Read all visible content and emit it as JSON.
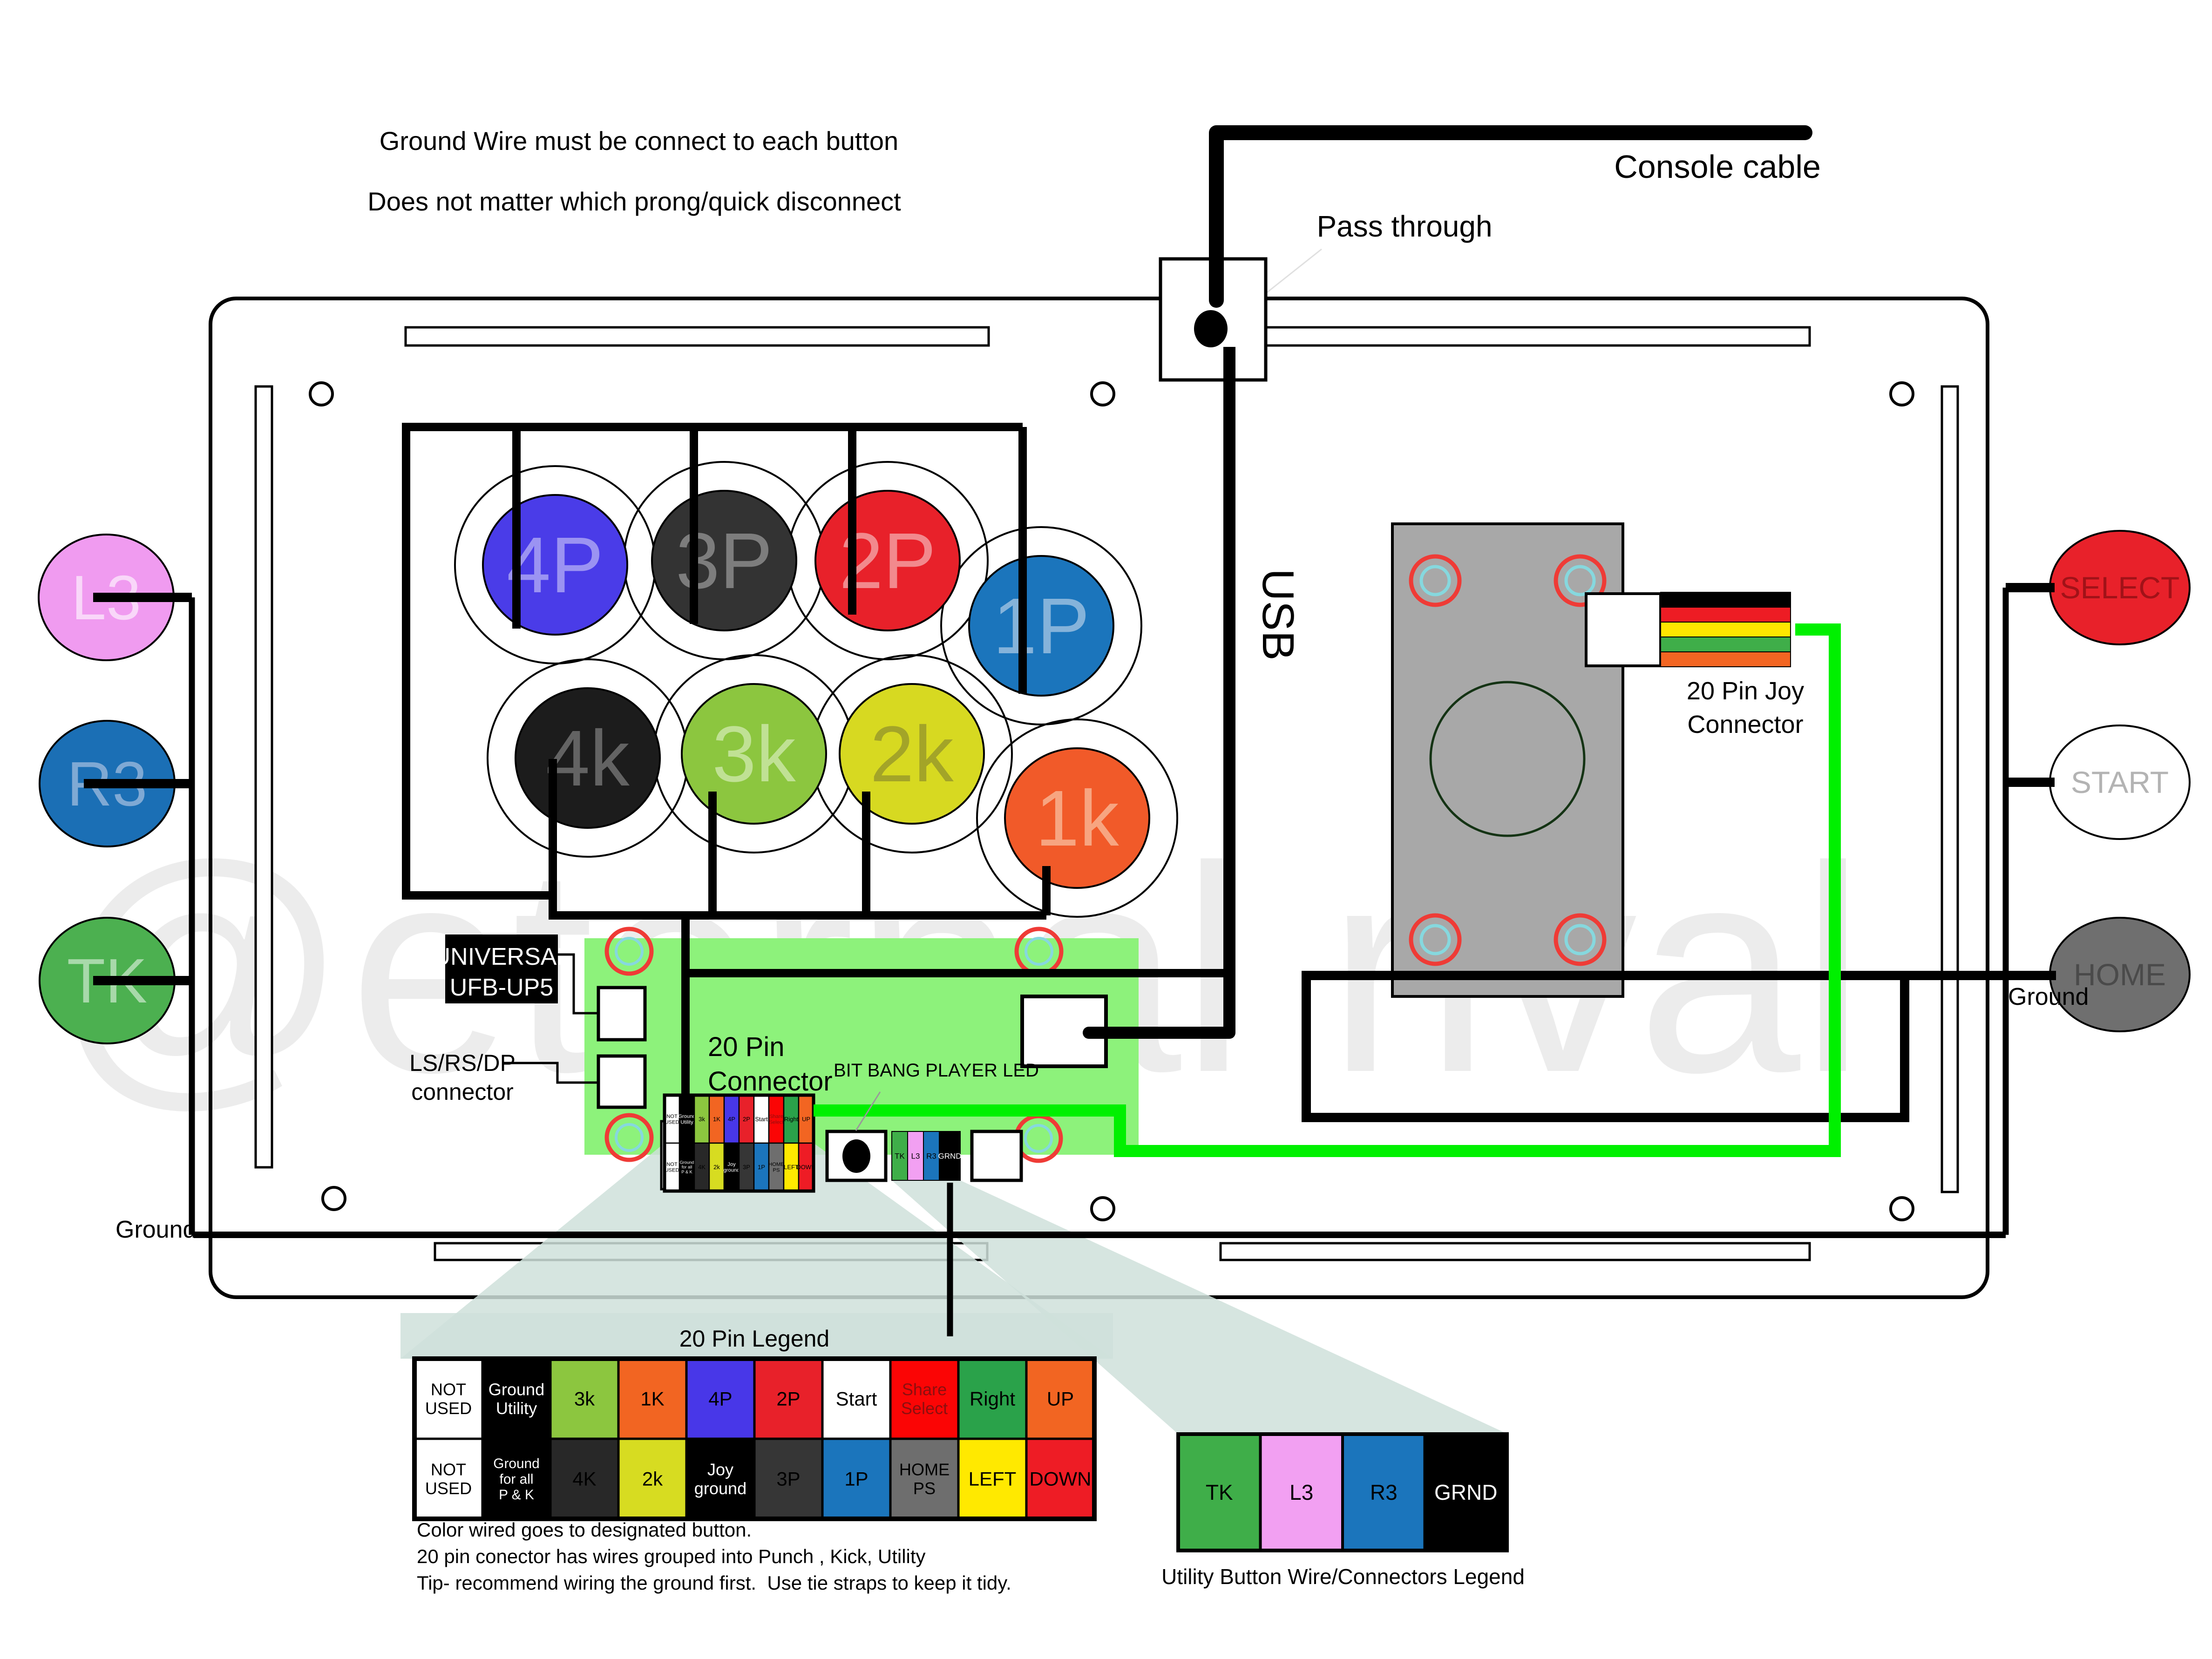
{
  "top_note": {
    "line1": "Ground Wire must be connect to each button",
    "line2": "Does not matter which prong/quick disconnect"
  },
  "labels": {
    "console_cable": "Console cable",
    "pass_through": "Pass through",
    "usb": "USB",
    "universal_line1": "UNIVERSAL",
    "universal_line2": "UFB-UP5",
    "lsrsdp_line1": "LS/RS/DP",
    "lsrsdp_line2": "connector",
    "pin20_line1": "20 Pin",
    "pin20_line2": "Connector",
    "bitbang": "BIT BANG PLAYER LED",
    "joy_line1": "20 Pin Joy",
    "joy_line2": "Connector",
    "ground_left": "Ground",
    "ground_right": "Ground",
    "legend20_title": "20 Pin Legend",
    "utility_title": "Utility Button Wire/Connectors Legend"
  },
  "notes": [
    "Color wired goes to designated button.",
    "20 pin conector has wires grouped into Punch , Kick, Utility",
    "Tip- recommend wiring the ground first.  Use tie straps to keep it tidy."
  ],
  "watermark": "@eternal rival",
  "buttons": {
    "main": [
      {
        "label": "4P",
        "color": "#4a3ce8",
        "text_color": "#9b93f2"
      },
      {
        "label": "3P",
        "color": "#333333",
        "text_color": "#7d7d7d"
      },
      {
        "label": "2P",
        "color": "#e8212a",
        "text_color": "#f2898d"
      },
      {
        "label": "1P",
        "color": "#1b75bc",
        "text_color": "#85b3da"
      },
      {
        "label": "4k",
        "color": "#1c1c1c",
        "text_color": "#636363"
      },
      {
        "label": "3k",
        "color": "#8cc63f",
        "text_color": "#c0e194"
      },
      {
        "label": "2k",
        "color": "#d7d921",
        "text_color": "#a3a428"
      },
      {
        "label": "1k",
        "color": "#f15a29",
        "text_color": "#f7a581"
      }
    ],
    "left": [
      {
        "label": "L3",
        "color": "#f09bf0",
        "text_color": "#f9d7f9"
      },
      {
        "label": "R3",
        "color": "#1b6fb5",
        "text_color": "#7fa9d4"
      },
      {
        "label": "TK",
        "color": "#4cb050",
        "text_color": "#a8d9aa"
      }
    ],
    "right": [
      {
        "label": "SELECT",
        "color": "#e8212a",
        "text_color": "#a11218"
      },
      {
        "label": "START",
        "color": "#ffffff",
        "text_color": "#b3b3b3"
      },
      {
        "label": "HOME",
        "color": "#6f6f6f",
        "text_color": "#4a4a4a"
      }
    ]
  },
  "pins": {
    "row1": [
      {
        "label": "NOT USED",
        "lines": [
          "NOT",
          "USED"
        ],
        "bg": "#ffffff",
        "fg": "#000000"
      },
      {
        "label": "Ground Utility",
        "lines": [
          "Ground",
          "Utility"
        ],
        "bg": "#000000",
        "fg": "#ffffff"
      },
      {
        "label": "3k",
        "bg": "#8cc63f",
        "fg": "#000000"
      },
      {
        "label": "1K",
        "bg": "#f26522",
        "fg": "#000000"
      },
      {
        "label": "4P",
        "bg": "#4837e8",
        "fg": "#000000"
      },
      {
        "label": "2P",
        "bg": "#e8212a",
        "fg": "#000000"
      },
      {
        "label": "Start",
        "bg": "#ffffff",
        "fg": "#000000"
      },
      {
        "label": "Share Select",
        "lines": [
          "Share",
          "Select"
        ],
        "bg": "#fb0505",
        "fg": "#8b0f0f"
      },
      {
        "label": "Right",
        "bg": "#2aa24a",
        "fg": "#000000"
      },
      {
        "label": "UP",
        "bg": "#f26522",
        "fg": "#000000"
      }
    ],
    "row2": [
      {
        "label": "NOT USED",
        "lines": [
          "NOT",
          "USED"
        ],
        "bg": "#ffffff",
        "fg": "#000000"
      },
      {
        "label": "Ground for all P & K",
        "lines": [
          "Ground",
          "for all",
          "P & K"
        ],
        "small": true,
        "bg": "#000000",
        "fg": "#ffffff"
      },
      {
        "label": "4K",
        "bg": "#282828",
        "fg": "#000000"
      },
      {
        "label": "2k",
        "bg": "#d7dc21",
        "fg": "#000000"
      },
      {
        "label": "Joy ground",
        "lines": [
          "Joy",
          "ground"
        ],
        "bg": "#000000",
        "fg": "#ffffff"
      },
      {
        "label": "3P",
        "bg": "#363636",
        "fg": "#000000"
      },
      {
        "label": "1P",
        "bg": "#1b75bc",
        "fg": "#000000"
      },
      {
        "label": "HOME PS",
        "lines": [
          "HOME",
          "PS"
        ],
        "bg": "#6e6e6e",
        "fg": "#000000"
      },
      {
        "label": "LEFT",
        "bg": "#ffe900",
        "fg": "#000000"
      },
      {
        "label": "DOWN",
        "bg": "#ee1c25",
        "fg": "#000000"
      }
    ]
  },
  "utility_pins": [
    {
      "label": "TK",
      "bg": "#3fae49",
      "fg": "#000000"
    },
    {
      "label": "L3",
      "bg": "#f2a0f2",
      "fg": "#000000"
    },
    {
      "label": "R3",
      "bg": "#1b75bc",
      "fg": "#000000"
    },
    {
      "label": "GRND",
      "bg": "#000000",
      "fg": "#ffffff"
    }
  ],
  "ribbon_colors": [
    "#000000",
    "#ed1c24",
    "#ffe600",
    "#3fae49",
    "#f26522"
  ],
  "colors": {
    "board": "#8df27b",
    "beam": "#cfe0db",
    "wire_green": "#00f000",
    "joystick": "#a8a8a8",
    "hole_red": "#ef3b36",
    "hole_teal": "#86d8de",
    "watermark": "#ececec"
  }
}
